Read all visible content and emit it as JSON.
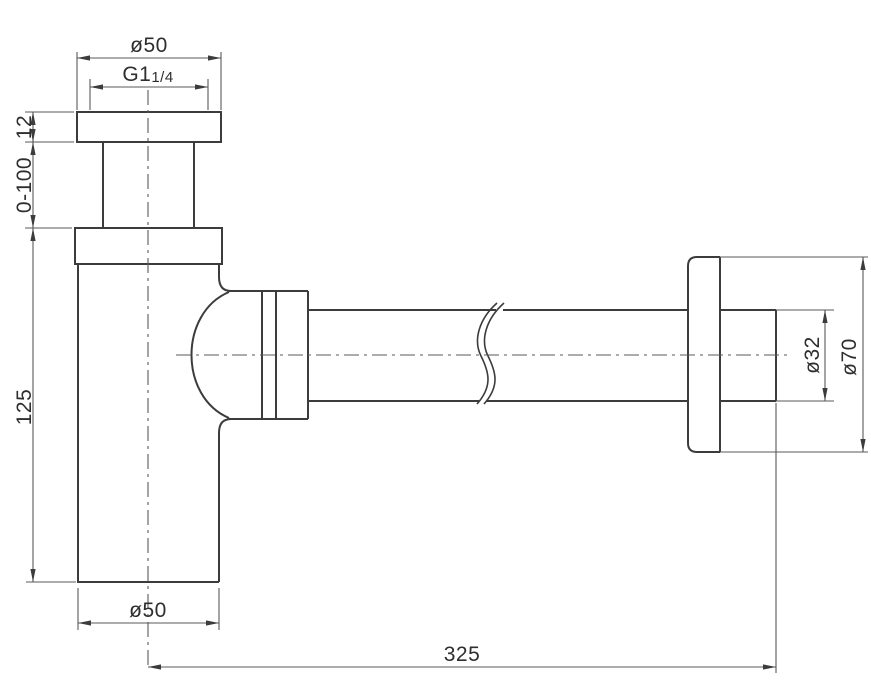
{
  "drawing": {
    "component": "bottle-trap-siphon",
    "dims": {
      "top_flange_dia": "ø50",
      "thread_prefix": "G1",
      "thread_fraction": "1/4",
      "flange_thickness": "12",
      "adjust_range": "0-100",
      "body_height": "125",
      "body_dia": "ø50",
      "overall_length": "325",
      "pipe_dia": "ø32",
      "wall_flange_dia": "ø70"
    },
    "colors": {
      "bg": "#ffffff",
      "outline": "#3c3c3c",
      "dim": "#5a5a5a",
      "text": "#2e2e2e"
    }
  }
}
